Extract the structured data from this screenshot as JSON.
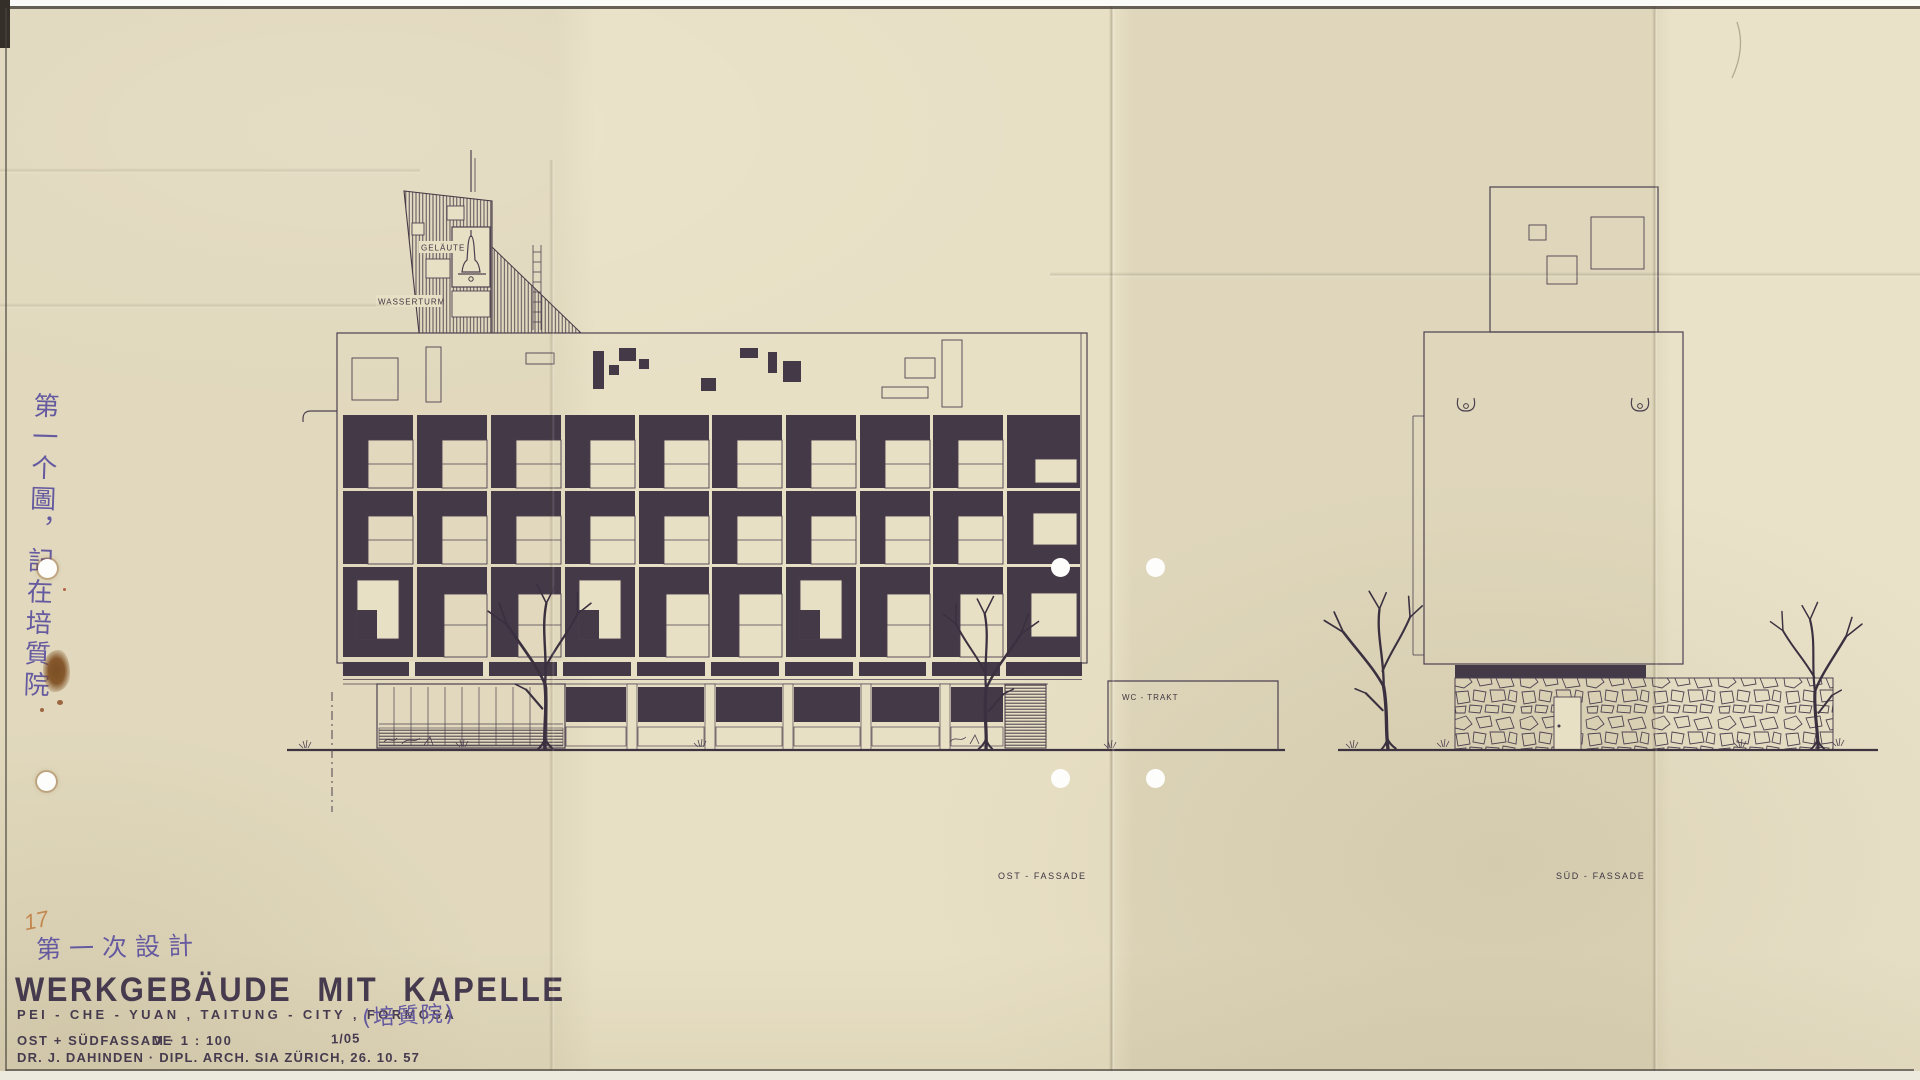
{
  "document": {
    "type": "scanned architectural elevation drawing",
    "sheet_title": "WERKGEBÄUDE MIT KAPELLE"
  },
  "drawing_labels": {
    "gelaeute": "GELÄUTE",
    "wasserturm": "WASSERTURM",
    "wc_trakt": "WC - TRAKT",
    "ost_fassade": "OST - FASSADE",
    "sued_fassade": "SÜD - FASSADE"
  },
  "margin_note_vertical": "第一个圖，記在培質院",
  "title_block": {
    "pencil_number": "17",
    "chinese_note": "第一次設計",
    "title": "WERKGEBÄUDE MIT KAPELLE",
    "subtitle": "PEI - CHE - YUAN , TAITUNG - CITY , FORMOSA",
    "chinese_parenthetical": "(培質院)",
    "drawing_content": "OST + SÜDFASSADE",
    "scale": "M · 1 : 100",
    "sheet_number": "1/05",
    "architect_line": "DR. J. DAHINDEN  ·  DIPL. ARCH. SIA ZÜRICH, 26. 10. 57"
  },
  "colors": {
    "paper": "#e8e0c5",
    "ink": "#443947",
    "ink-line": "#4d4150",
    "blue-ink": "#655aa0",
    "pencil-orange": "#c07c3f",
    "title-ink": "#463b4e"
  }
}
